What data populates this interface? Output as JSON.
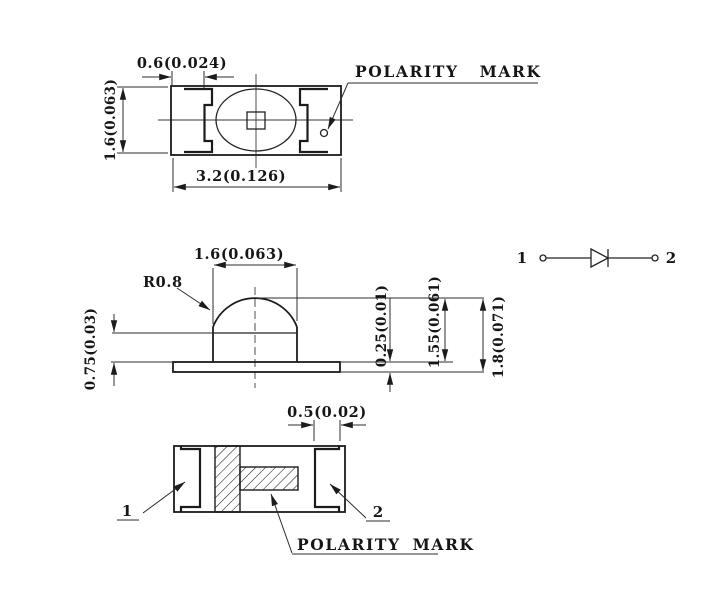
{
  "drawing": {
    "top_view": {
      "pad_width_dim": "0.6(0.024)",
      "height_dim": "1.6(0.063)",
      "width_dim": "3.2(0.126)",
      "polarity_label": "POLARITY MARK"
    },
    "side_view": {
      "dome_width_dim": "1.6(0.063)",
      "dome_radius_dim": "R0.8",
      "standoff_dim": "0.75(0.03)",
      "base_thickness_dim": "0.25(0.01)",
      "body_height_dim": "1.55(0.061)",
      "total_height_dim": "1.8(0.071)"
    },
    "bottom_view": {
      "pad_width_dim": "0.5(0.02)",
      "pin1_label": "1",
      "pin2_label": "2",
      "polarity_label": "POLARITY MARK"
    },
    "circuit_symbol": {
      "pin1_label": "1",
      "pin2_label": "2"
    },
    "colors": {
      "line": "#1c1c1c",
      "background": "#ffffff"
    }
  }
}
